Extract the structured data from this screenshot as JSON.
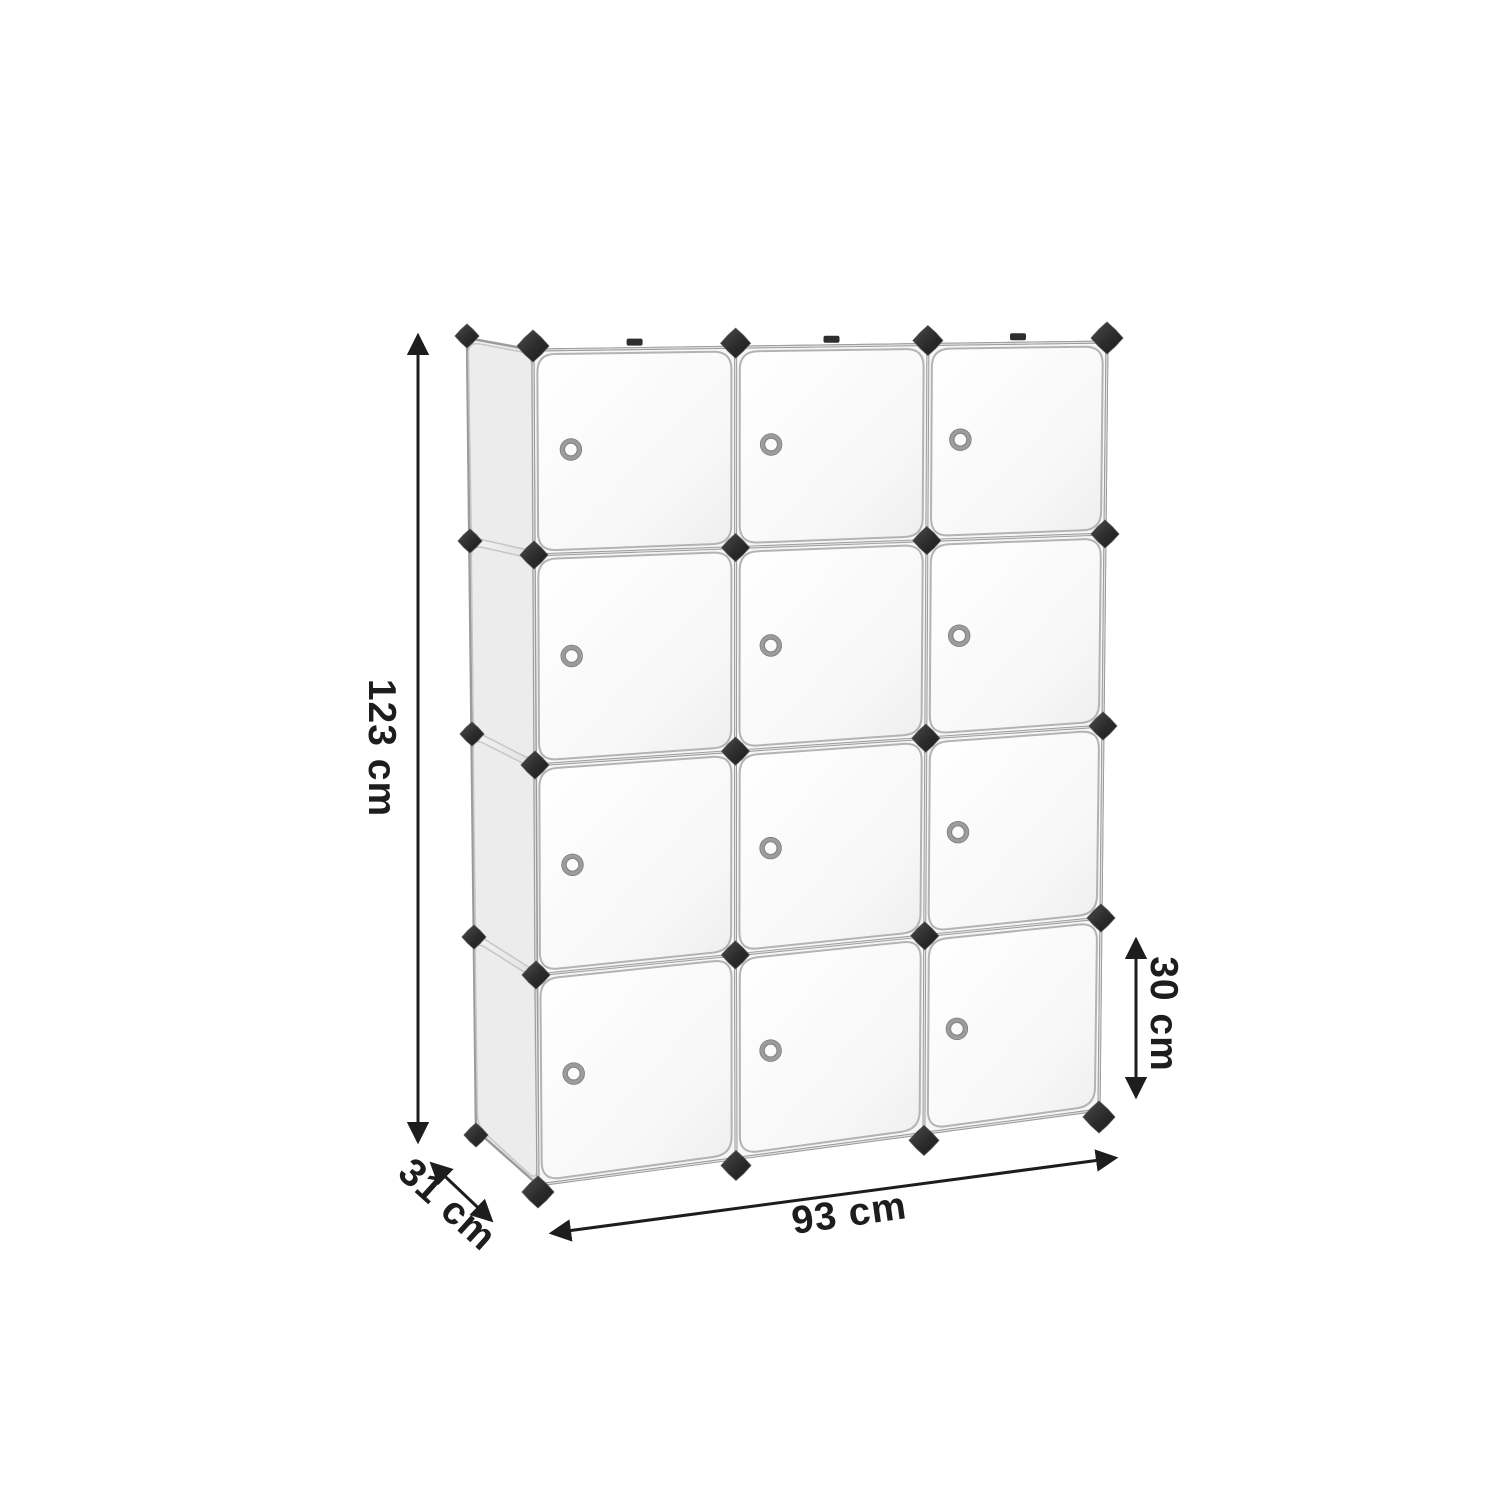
{
  "figure": {
    "title": "Cube storage organizer dimension diagram",
    "type": "product-dimension-diagram",
    "subject": "modular cube storage organizer with doors",
    "grid": {
      "rows": 4,
      "columns": 3,
      "door_count": 12,
      "handles_per_door": 1
    },
    "features": [
      "white cube doors",
      "round metal door handles",
      "black corner connectors",
      "silver frame edges",
      "left side panel visible in perspective"
    ]
  },
  "dimensions": {
    "height": {
      "label": "123 cm",
      "value": 123,
      "unit": "cm"
    },
    "depth": {
      "label": "31 cm",
      "value": 31,
      "unit": "cm"
    },
    "width": {
      "label": "93 cm",
      "value": 93,
      "unit": "cm"
    },
    "cube_height": {
      "label": "30 cm",
      "value": 30,
      "unit": "cm"
    }
  },
  "colors": {
    "background": "#ffffff",
    "annotation": "#1d1d1d",
    "connector_dark": "#2b2b2b",
    "connector_light": "#4c4c4c",
    "frame_silver": "#9b9b9b",
    "frame_highlight": "#e4e4e4",
    "door_fill": "#fafafa",
    "door_edge": "#b3b3b3",
    "side_panel": "#ececec",
    "handle_metal": "#9c9c9c"
  }
}
